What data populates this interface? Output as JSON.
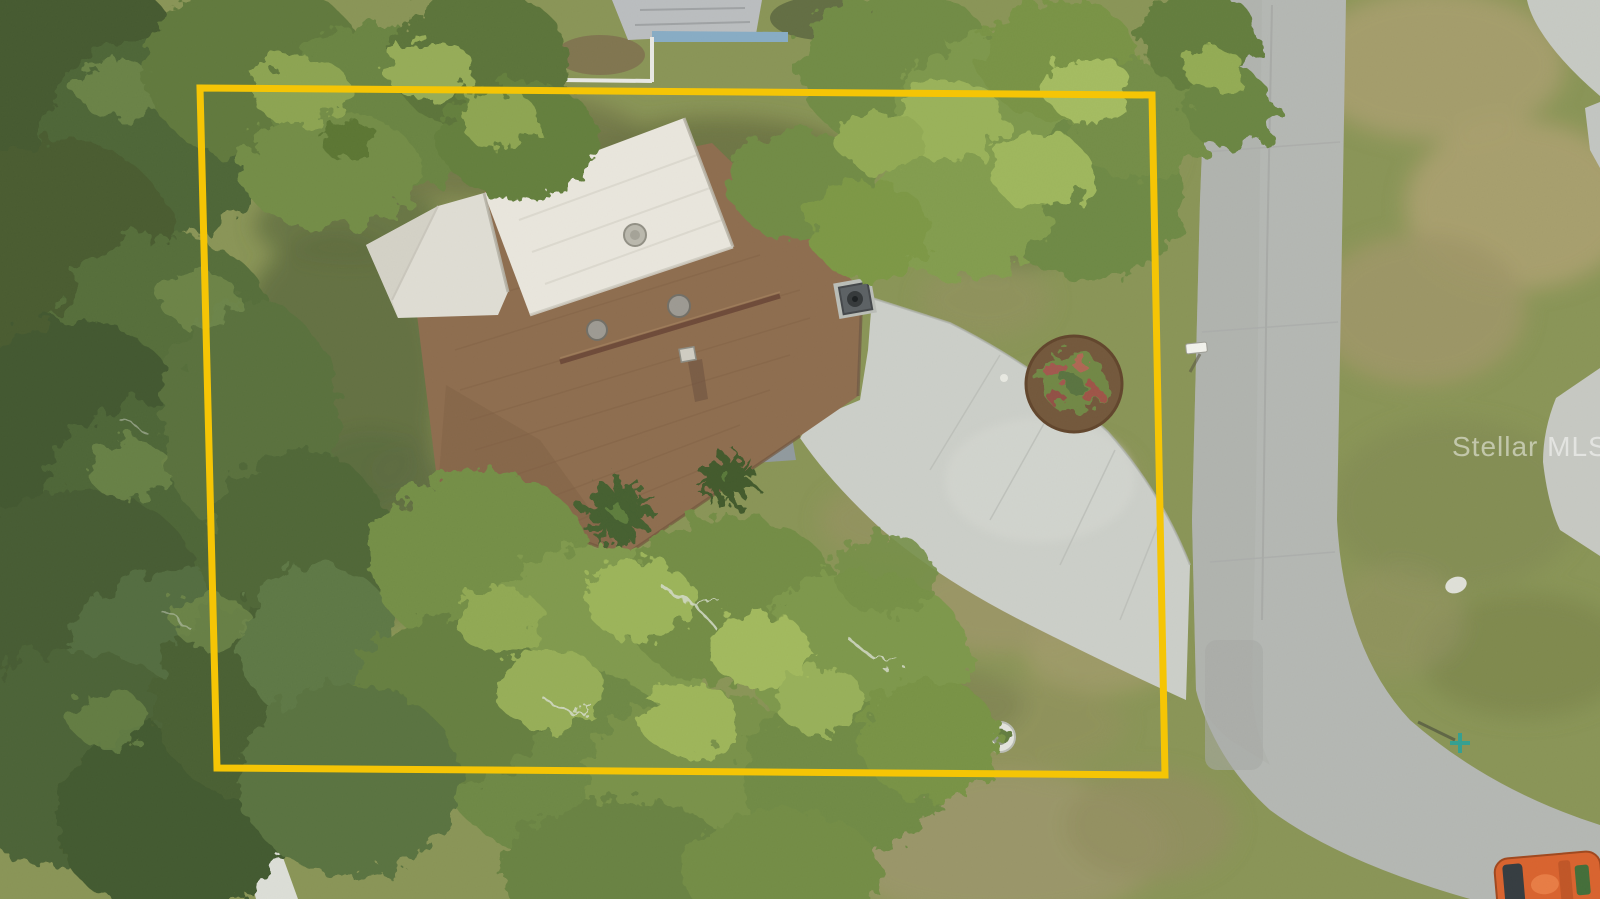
{
  "image": {
    "type": "aerial-drone-photo",
    "subject": "overhead view of single-family home lot with boundary overlay",
    "watermark": "Stellar MLS"
  },
  "boundary": {
    "shape": "rectangle",
    "points": "200,88 1152,95 1165,775 217,768",
    "stroke_width": "7"
  },
  "colors": {
    "boundary": "#F5C505",
    "road": "#B3B6B2",
    "driveway": "#CBCEC8",
    "walkway": "#DCDED7",
    "roof_shingle": "#8B694A",
    "roof_flat": "#E9E6DD",
    "garage_roof": "#DFDDD3",
    "entry_patio": "#8E989C",
    "grass_base": "#879252",
    "mulch": "#6F5336",
    "vehicle_orange": "#D95F28",
    "watermark_color": "rgba(255,255,255,0.5)"
  },
  "features": [
    "dense tree canopy",
    "brown shingle roof",
    "white flat roof section",
    "curved concrete driveway",
    "residential road",
    "yellow lot boundary",
    "circular landscape bed",
    "mailbox",
    "well cover",
    "neighboring house",
    "orange utility vehicle"
  ]
}
